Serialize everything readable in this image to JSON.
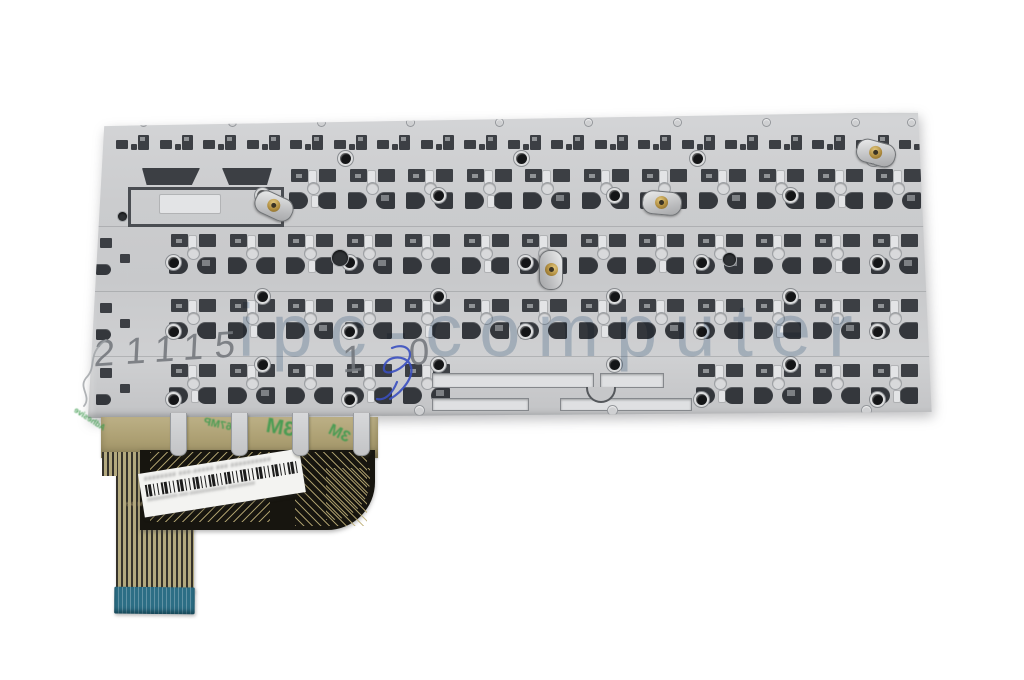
{
  "photo": {
    "subject": "rear metal backplate of a laptop keyboard with ribbon cable",
    "background_color": "#ffffff"
  },
  "watermark": {
    "text": "ipc-computer",
    "color": "#9db3c9"
  },
  "handwriting": {
    "pencil_left": "21115",
    "pencil_right": "1 0",
    "pencil_color": "#73777c",
    "pen_scribble_color": "#3a4fc0"
  },
  "plate": {
    "base_color": "#cbccce",
    "cutout_color": "#3c3f44",
    "screw_color": "#141517",
    "standoff_brass_color": "#b08d3f"
  },
  "ribbon": {
    "tape_color": "#ac9f72",
    "tape_print_color": "#3f9b4f",
    "tape_print": [
      "Adhesive",
      "467MP",
      "3M",
      "3M"
    ],
    "flex_color": "#17150f",
    "flex_print": "64 MASK DPL SOLU HO",
    "stiffener_color": "#2c6e85"
  },
  "sticker": {
    "blurred_line1": "######## ###-##### ### ##########",
    "blurred_sub": "##########-###-############ #########",
    "barcode": true,
    "bg": "#f3f3f1"
  },
  "plate_pattern": {
    "fn_row": {
      "y": 133,
      "x0": 114,
      "pitch": 43.5,
      "count": 19
    },
    "rows": [
      {
        "y": 166,
        "x0": 288,
        "pitch": 58.5,
        "count": 11,
        "skip": []
      },
      {
        "y": 231,
        "x0": 168,
        "pitch": 58.5,
        "count": 13,
        "skip": []
      },
      {
        "y": 296,
        "x0": 168,
        "pitch": 58.5,
        "count": 13,
        "skip": []
      },
      {
        "y": 361,
        "x0": 168,
        "pitch": 58.5,
        "count": 13,
        "skip": [
          5,
          6,
          7,
          8
        ]
      }
    ],
    "screw_rows": [
      {
        "y": 153,
        "xs": [
          340,
          516,
          692,
          868
        ]
      },
      {
        "y": 190,
        "xs": [
          257,
          433,
          609,
          785
        ]
      },
      {
        "y": 257,
        "xs": [
          168,
          344,
          520,
          696,
          872
        ]
      },
      {
        "y": 291,
        "xs": [
          257,
          433,
          609,
          785
        ]
      },
      {
        "y": 326,
        "xs": [
          168,
          344,
          520,
          696,
          872
        ]
      },
      {
        "y": 359,
        "xs": [
          257,
          433,
          609,
          785
        ]
      },
      {
        "y": 394,
        "xs": [
          168,
          344,
          696,
          872
        ]
      }
    ],
    "rivets_top": {
      "y": 119,
      "xs": [
        140,
        229,
        318,
        407,
        496,
        585,
        674,
        763,
        852,
        908
      ]
    },
    "rivets_bottom": {
      "y": 406,
      "xs": [
        415,
        608,
        862
      ]
    },
    "standoffs": [
      {
        "x": 254,
        "y": 194,
        "rot": 25
      },
      {
        "x": 642,
        "y": 191,
        "rot": 5
      },
      {
        "x": 856,
        "y": 141,
        "rot": 15
      },
      {
        "x": 531,
        "y": 258,
        "rot": 90
      }
    ],
    "holes": [
      {
        "x": 332,
        "y": 250,
        "d": 16
      },
      {
        "x": 723,
        "y": 253,
        "d": 13
      },
      {
        "x": 118,
        "y": 212,
        "d": 9
      }
    ],
    "tab_xs": [
      170,
      231,
      292,
      353
    ]
  }
}
